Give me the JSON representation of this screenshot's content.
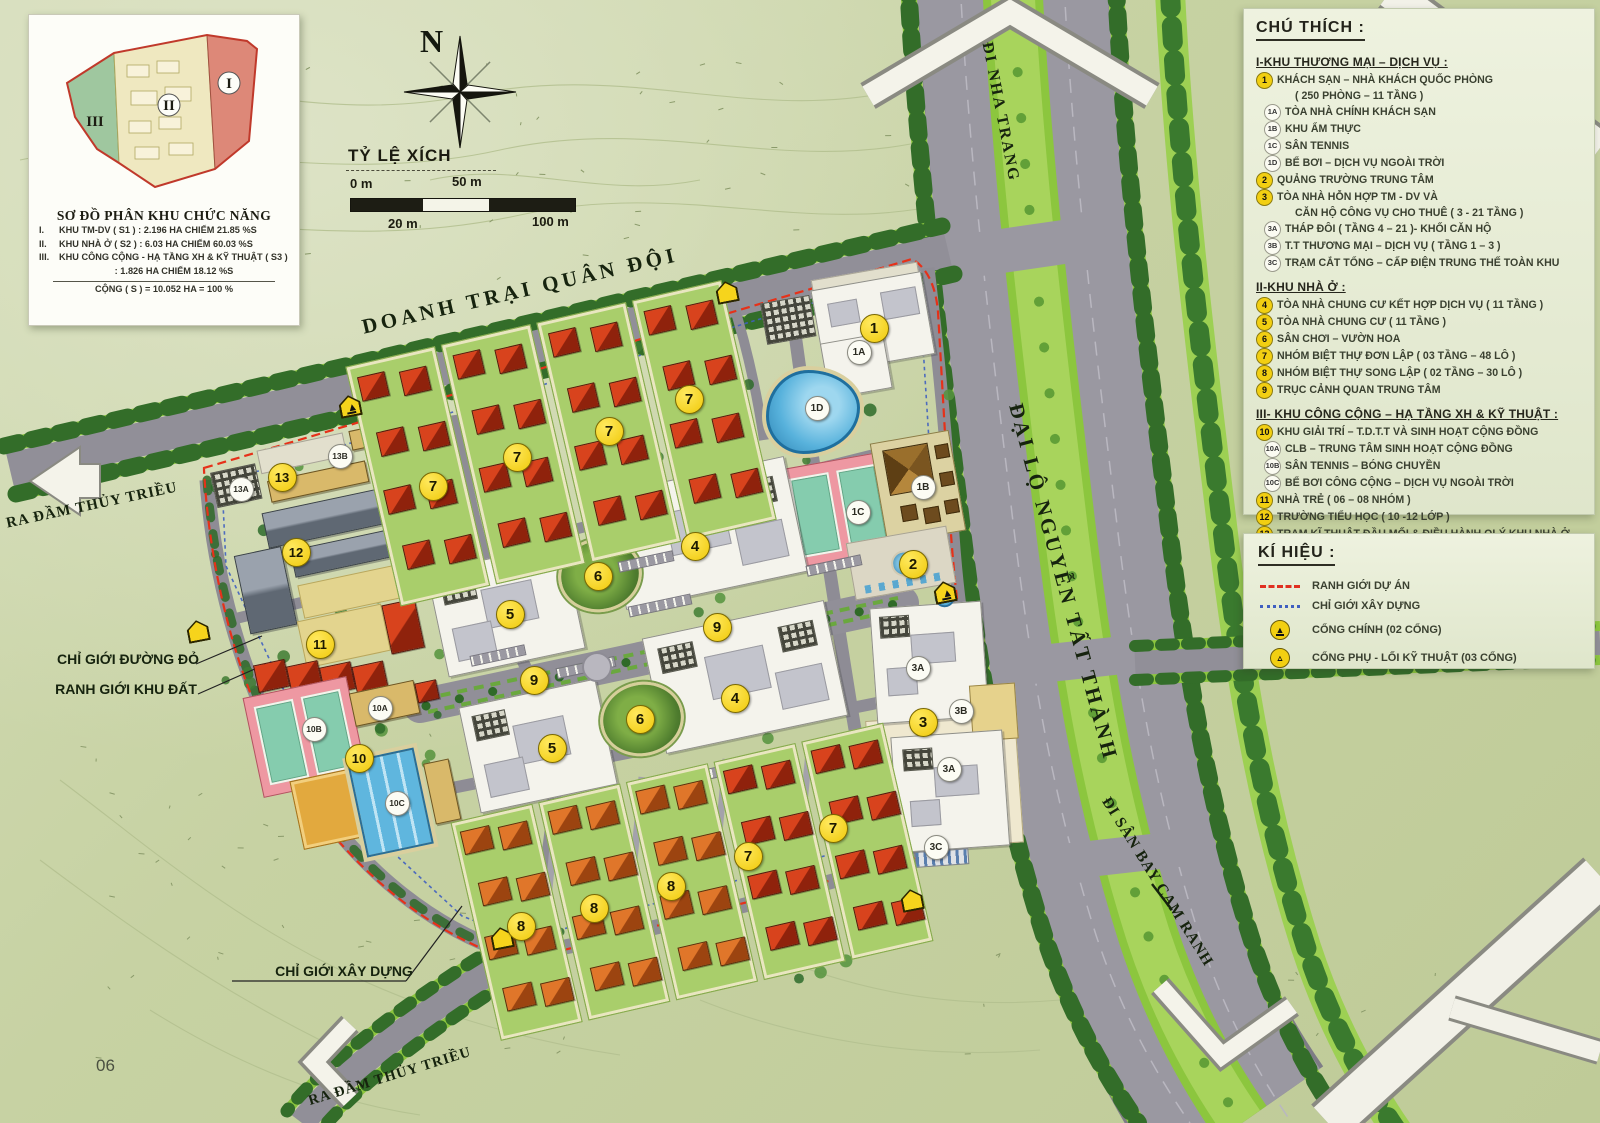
{
  "page": {
    "number": "06"
  },
  "inset": {
    "title": "SƠ ĐỒ PHÂN KHU CHỨC NĂNG",
    "rows": [
      {
        "num": "I.",
        "text": "KHU TM-DV ( S1 ) : 2.196 HA CHIẾM 21.85 %S"
      },
      {
        "num": "II.",
        "text": "KHU NHÀ Ở ( S2 ) : 6.03 HA CHIẾM 60.03 %S"
      },
      {
        "num": "III.",
        "text": "KHU CÔNG CỘNG - HẠ TẦNG XH & KỸ THUẬT ( S3 )"
      },
      {
        "num": "",
        "text": ": 1.826 HA CHIẾM 18.12 %S"
      }
    ],
    "total": "CỘNG ( S ) = 10.052 HA = 100 %",
    "zones": [
      {
        "label": "I"
      },
      {
        "label": "II"
      },
      {
        "label": "III"
      }
    ]
  },
  "compass": {
    "label": "N"
  },
  "scalebar": {
    "title": "TỶ LỆ XÍCH",
    "t0": "0 m",
    "t50": "50 m",
    "t20": "20 m",
    "t100": "100 m"
  },
  "legend": {
    "title": "CHÚ THÍCH :",
    "sections": [
      {
        "heading": "I-KHU THƯƠNG MẠI – DỊCH VỤ :",
        "items": [
          {
            "badge": "1",
            "text": "KHÁCH SẠN – NHÀ KHÁCH QUỐC PHÒNG"
          },
          {
            "badge": "",
            "text": "( 250 PHÒNG – 11 TẦNG )"
          },
          {
            "badge": "1A",
            "text": "TÒA NHÀ CHÍNH KHÁCH SẠN"
          },
          {
            "badge": "1B",
            "text": "KHU ẨM THỰC"
          },
          {
            "badge": "1C",
            "text": "SÂN TENNIS"
          },
          {
            "badge": "1D",
            "text": "BỂ BƠI – DỊCH VỤ NGOÀI TRỜI"
          },
          {
            "badge": "2",
            "text": "QUẢNG TRƯỜNG TRUNG TÂM"
          },
          {
            "badge": "3",
            "text": "TÒA NHÀ HỖN HỢP TM - DV VÀ"
          },
          {
            "badge": "",
            "text": "CĂN HỘ CÔNG VỤ CHO THUÊ ( 3 - 21 TẦNG )"
          },
          {
            "badge": "3A",
            "text": "THÁP ĐÔI ( TẦNG 4 – 21 )- KHỐI CĂN HỘ"
          },
          {
            "badge": "3B",
            "text": "T.T THƯƠNG MẠI – DỊCH VỤ ( TẦNG 1 – 3 )"
          },
          {
            "badge": "3C",
            "text": "TRẠM CẮT TỔNG – CẤP ĐIỆN TRUNG THẾ TOÀN KHU"
          }
        ]
      },
      {
        "heading": "II-KHU NHÀ Ở :",
        "items": [
          {
            "badge": "4",
            "text": "TÒA NHÀ CHUNG CƯ KẾT HỢP DỊCH VỤ ( 11 TẦNG )"
          },
          {
            "badge": "5",
            "text": "TÒA NHÀ CHUNG CƯ ( 11 TẦNG )"
          },
          {
            "badge": "6",
            "text": "SÂN CHƠI – VƯỜN HOA"
          },
          {
            "badge": "7",
            "text": "NHÓM BIỆT THỰ ĐƠN LẬP ( 03 TẦNG – 48 LÔ )"
          },
          {
            "badge": "8",
            "text": "NHÓM BIỆT THỰ SONG LẬP ( 02 TẦNG – 30 LÔ )"
          },
          {
            "badge": "9",
            "text": "TRỤC CẢNH QUAN TRUNG TÂM"
          }
        ]
      },
      {
        "heading": "III- KHU CÔNG CỘNG – HẠ TẦNG XH & KỸ THUẬT :",
        "items": [
          {
            "badge": "10",
            "text": "KHU GIẢI TRÍ – T.D.T.T VÀ SINH HOẠT CỘNG ĐỒNG"
          },
          {
            "badge": "10A",
            "text": "CLB – TRUNG TÂM SINH HOẠT CỘNG ĐỒNG"
          },
          {
            "badge": "10B",
            "text": "SÂN TENNIS – BÓNG CHUYỀN"
          },
          {
            "badge": "10C",
            "text": "BỂ BƠI CÔNG CỘNG – DỊCH VỤ NGOÀI TRỜI"
          },
          {
            "badge": "11",
            "text": "NHÀ TRẺ ( 06 – 08 NHÓM )"
          },
          {
            "badge": "12",
            "text": "TRƯỜNG TIỂU HỌC ( 10 -12 LỚP )"
          },
          {
            "badge": "13",
            "text": "TRẠM KĨ THUẬT ĐẦU MỐI & ĐIỀU HÀNH QLÝ KHU NHÀ Ở"
          },
          {
            "badge": "13A",
            "text": "KHU ĐIỀU HÀNH – TRẠM CẤP NƯỚC SINH HOẠT"
          },
          {
            "badge": "13B",
            "text": "KHU XỬ LÝ NƯỚC THẢI TRUNG TÂM"
          }
        ]
      }
    ]
  },
  "symbols": {
    "title": "KÍ HIỆU :",
    "items": [
      {
        "icon": "red-dash",
        "text": "RANH GIỚI DỰ ÁN"
      },
      {
        "icon": "blue-dash",
        "text": "CHỈ GIỚI XÂY DỰNG"
      },
      {
        "icon": "gate-main",
        "text": "CỔNG CHÍNH (02 CỔNG)"
      },
      {
        "icon": "gate-sub",
        "text": "CỔNG PHỤ - LỐI KỸ THUẬT (03 CỔNG)"
      }
    ]
  },
  "map_labels": [
    {
      "id": "doanh_trai",
      "text": "DOANH TRẠI QUÂN ĐỘI"
    },
    {
      "id": "di_nha_trang",
      "text": "ĐI NHA TRANG"
    },
    {
      "id": "dai_lo",
      "text": "ĐẠI LỘ NGUYỄN TẤT THÀNH"
    },
    {
      "id": "di_san_bay",
      "text": "ĐI SÂN BAY CAM RANH"
    },
    {
      "id": "ra_dam_trai",
      "text": "RA ĐẦM THỦY TRIỀU"
    },
    {
      "id": "ra_dam_duoi",
      "text": "RA ĐẦM THỦY TRIỀU"
    },
    {
      "id": "chi_gioi_duong_do",
      "text": "CHỈ GIỚI ĐƯỜNG ĐỎ"
    },
    {
      "id": "ranh_gioi_khu_dat",
      "text": "RANH GIỚI KHU ĐẤT"
    },
    {
      "id": "chi_gioi_xay_dung",
      "text": "CHỈ GIỚI XÂY DỰNG"
    }
  ],
  "markers": [
    {
      "label": "1",
      "kind": "yellow",
      "x": 873,
      "y": 327
    },
    {
      "label": "2",
      "kind": "yellow",
      "x": 912,
      "y": 563
    },
    {
      "label": "3",
      "kind": "yellow",
      "x": 922,
      "y": 721
    },
    {
      "label": "4",
      "kind": "yellow",
      "x": 694,
      "y": 545
    },
    {
      "label": "4",
      "kind": "yellow",
      "x": 734,
      "y": 697
    },
    {
      "label": "5",
      "kind": "yellow",
      "x": 509,
      "y": 613
    },
    {
      "label": "5",
      "kind": "yellow",
      "x": 551,
      "y": 747
    },
    {
      "label": "6",
      "kind": "yellow",
      "x": 597,
      "y": 575
    },
    {
      "label": "6",
      "kind": "yellow",
      "x": 639,
      "y": 718
    },
    {
      "label": "7",
      "kind": "yellow",
      "x": 432,
      "y": 485
    },
    {
      "label": "7",
      "kind": "yellow",
      "x": 516,
      "y": 456
    },
    {
      "label": "7",
      "kind": "yellow",
      "x": 608,
      "y": 430
    },
    {
      "label": "7",
      "kind": "yellow",
      "x": 688,
      "y": 398
    },
    {
      "label": "7",
      "kind": "yellow",
      "x": 832,
      "y": 827
    },
    {
      "label": "7",
      "kind": "yellow",
      "x": 747,
      "y": 855
    },
    {
      "label": "8",
      "kind": "yellow",
      "x": 520,
      "y": 925
    },
    {
      "label": "8",
      "kind": "yellow",
      "x": 593,
      "y": 907
    },
    {
      "label": "8",
      "kind": "yellow",
      "x": 670,
      "y": 885
    },
    {
      "label": "9",
      "kind": "yellow",
      "x": 716,
      "y": 626
    },
    {
      "label": "9",
      "kind": "yellow",
      "x": 533,
      "y": 679
    },
    {
      "label": "10",
      "kind": "yellow",
      "x": 358,
      "y": 757
    },
    {
      "label": "11",
      "kind": "yellow",
      "x": 319,
      "y": 643
    },
    {
      "label": "12",
      "kind": "yellow",
      "x": 295,
      "y": 551
    },
    {
      "label": "13",
      "kind": "yellow",
      "x": 281,
      "y": 476
    },
    {
      "label": "1A",
      "kind": "white",
      "x": 858,
      "y": 351
    },
    {
      "label": "1B",
      "kind": "white",
      "x": 922,
      "y": 486
    },
    {
      "label": "1C",
      "kind": "white",
      "x": 857,
      "y": 511
    },
    {
      "label": "1D",
      "kind": "white",
      "x": 816,
      "y": 407
    },
    {
      "label": "3A",
      "kind": "white",
      "x": 917,
      "y": 667
    },
    {
      "label": "3A",
      "kind": "white",
      "x": 948,
      "y": 768
    },
    {
      "label": "3B",
      "kind": "white",
      "x": 960,
      "y": 710
    },
    {
      "label": "3C",
      "kind": "white",
      "x": 935,
      "y": 846
    },
    {
      "label": "10A",
      "kind": "white",
      "x": 379,
      "y": 707
    },
    {
      "label": "10B",
      "kind": "white",
      "x": 313,
      "y": 728
    },
    {
      "label": "10C",
      "kind": "white",
      "x": 396,
      "y": 802
    },
    {
      "label": "13A",
      "kind": "white",
      "x": 240,
      "y": 488
    },
    {
      "label": "13B",
      "kind": "white",
      "x": 339,
      "y": 455
    }
  ],
  "gates": [
    {
      "type": "main",
      "x": 945,
      "y": 592
    },
    {
      "type": "main",
      "x": 350,
      "y": 406
    },
    {
      "type": "sub",
      "x": 198,
      "y": 631
    },
    {
      "type": "sub",
      "x": 502,
      "y": 938
    },
    {
      "type": "sub",
      "x": 912,
      "y": 900
    },
    {
      "type": "sub",
      "x": 727,
      "y": 292
    }
  ],
  "colors": {
    "boundary": "#e63119",
    "construction": "#3f5fc0",
    "marker_yellow": "#f2cf12",
    "median_green": "#8cc63e"
  }
}
